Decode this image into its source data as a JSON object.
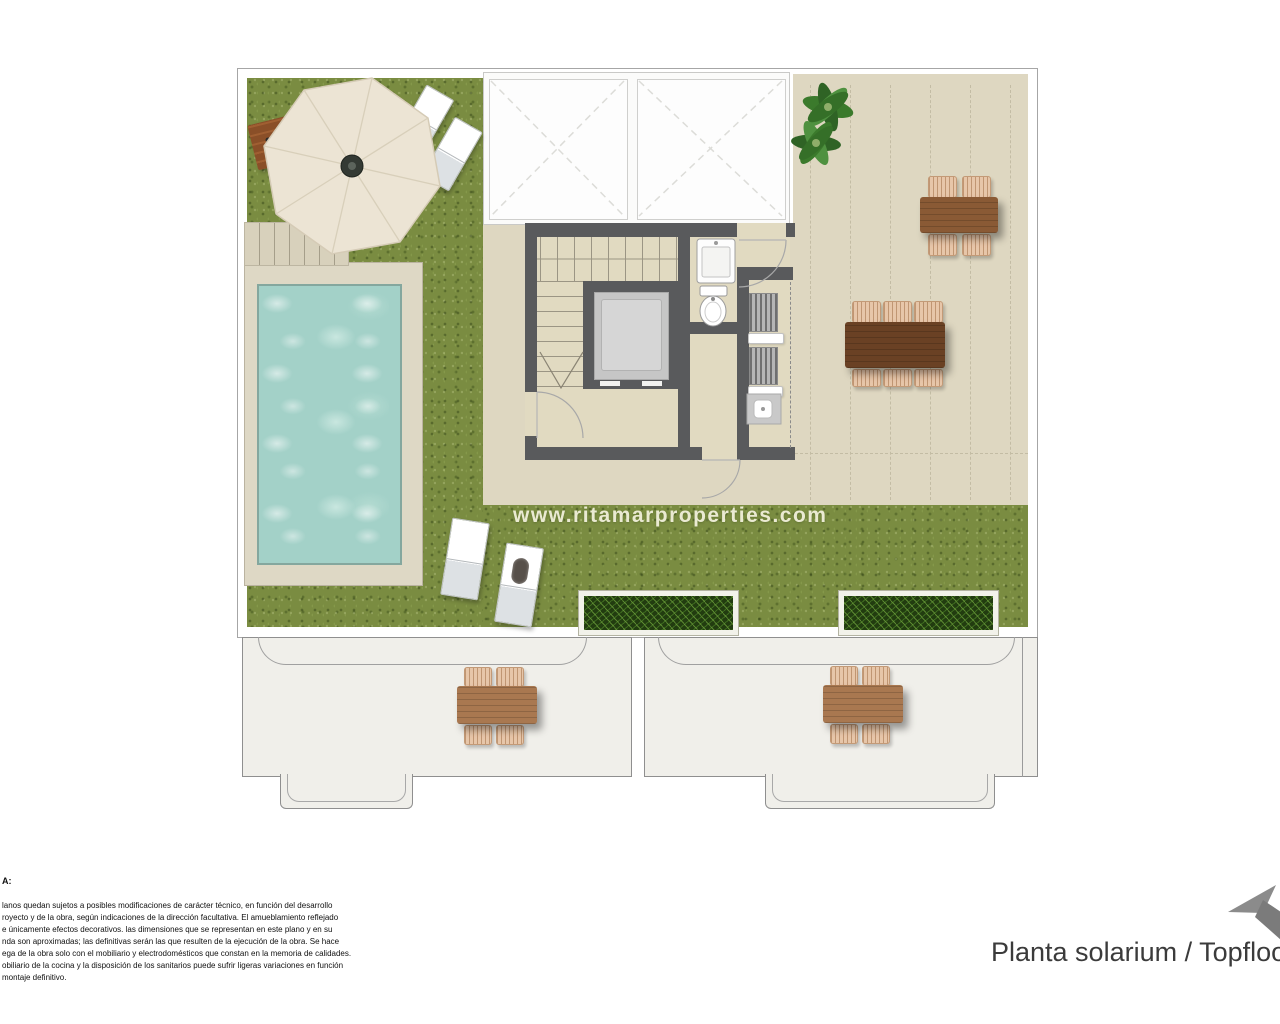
{
  "plan": {
    "watermark": "www.ritamarproperties.com",
    "colors": {
      "grass": "#7a8c41",
      "terrace_tile": "#ded7c1",
      "interior_floor": "#e1dac1",
      "wall": "#595a5c",
      "pool_water": "#a3d1c8",
      "pool_deck": "#ded8c5",
      "planter_green": "#223c10",
      "wood_dark": "#6a4124",
      "wood_medium": "#8a5a35",
      "wood_light": "#a97850",
      "lower_terrace": "#f0efea",
      "umbrella": "#ece4d4",
      "logo_arrow": "#8a8a8a"
    },
    "objects": [
      "umbrella-icon",
      "wood-deck-icon",
      "sun-lounger-icon",
      "swimming-pool-icon",
      "stairs-icon",
      "elevator-icon",
      "washbasin-icon",
      "toilet-icon",
      "louver-unit-icon",
      "shelf-icon",
      "appliance-icon",
      "plant-icon",
      "dining-table-6-icon",
      "dining-table-4-icon",
      "planter-icon",
      "skylight-icon"
    ]
  },
  "footer": {
    "note_label": "A:",
    "disclaimer_lines": [
      "lanos quedan sujetos a posibles modificaciones de carácter técnico, en función del desarrollo",
      "royecto y de la obra, según indicaciones de la dirección facultativa. El amueblamiento reflejado",
      "e únicamente efectos decorativos. las dimensiones que se representan en este plano y en su",
      "nda son aproximadas; las definitivas serán las que resulten de la ejecución de la obra. Se hace",
      "ega de la obra solo con el mobiliario y electrodomésticos que constan en la memoria de calidades.",
      "obiliario de la cocina y la disposición de los sanitarios puede sufrir ligeras variaciones en función",
      "montaje definitivo."
    ],
    "title": "Planta solarium / Topfloor"
  }
}
